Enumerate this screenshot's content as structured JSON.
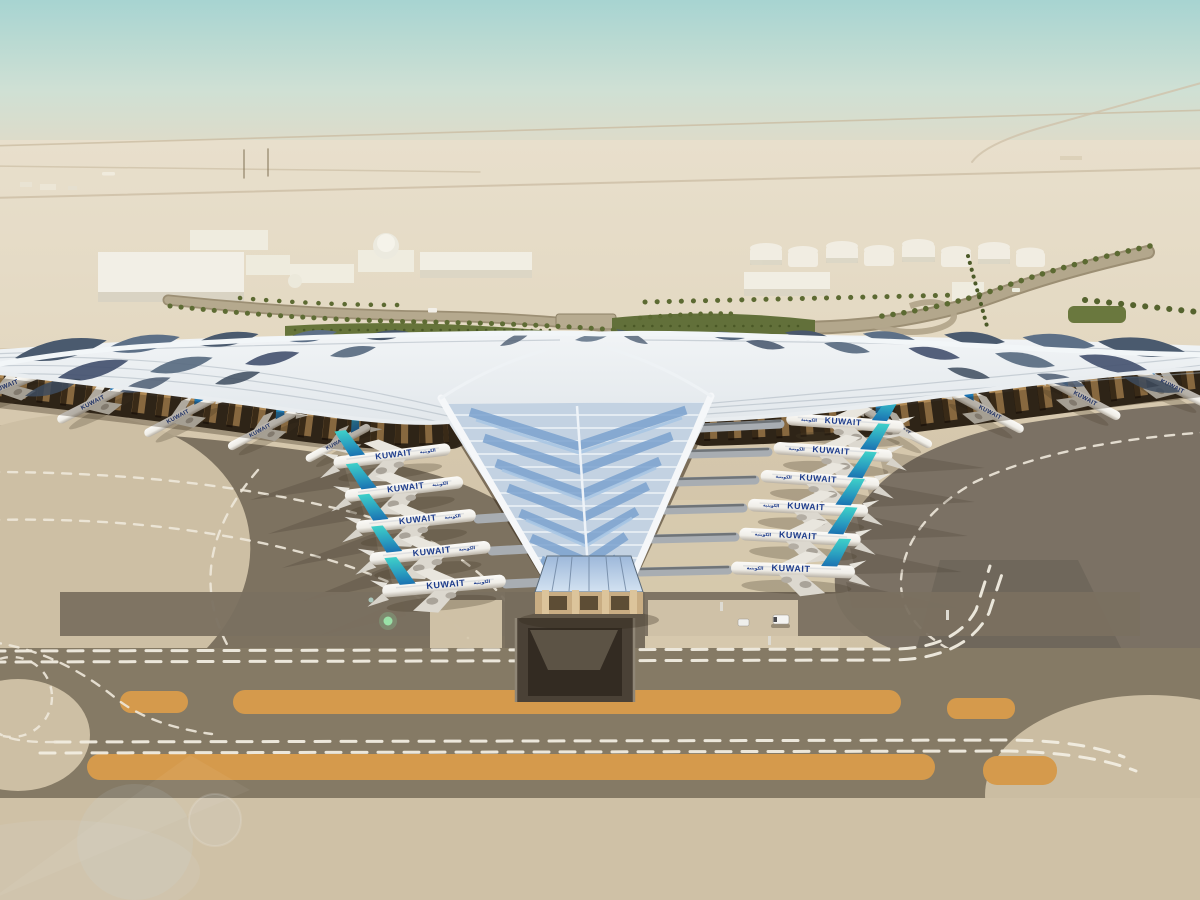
{
  "scene": {
    "description": "Aerial rendering of a desert airport terminal with a sweeping trefoil photovoltaic roof, aircraft parked at gates, approach roads, fuel farm and taxiways",
    "aircraft_livery": {
      "title": "KUWAIT",
      "arabic_title": "الكويتية"
    },
    "counts": {
      "inner_left_aircraft": 5,
      "inner_right_aircraft": 6,
      "outer_left_aircraft": 5,
      "outer_right_aircraft": 4,
      "fuel_tanks": 8
    },
    "palette": {
      "sky_top": "#a7d4d1",
      "sky_horizon": "#e6dcc9",
      "desert": "#ddd0b6",
      "apron": "#d5c7ac",
      "asphalt": "#7d7260",
      "taxiway_marking": "#f1ede1",
      "orange_marking": "#d59a4c",
      "roof_silver": "#dde3e8",
      "roof_pv": "#4c5c70",
      "skylight_blue": "#9db8da",
      "tail_teal": "#3fd0c9",
      "tail_blue": "#1a6fb0",
      "title_blue": "#1d3c8c",
      "greenery": "#66743a",
      "underside_amber": "#c79b60"
    }
  }
}
